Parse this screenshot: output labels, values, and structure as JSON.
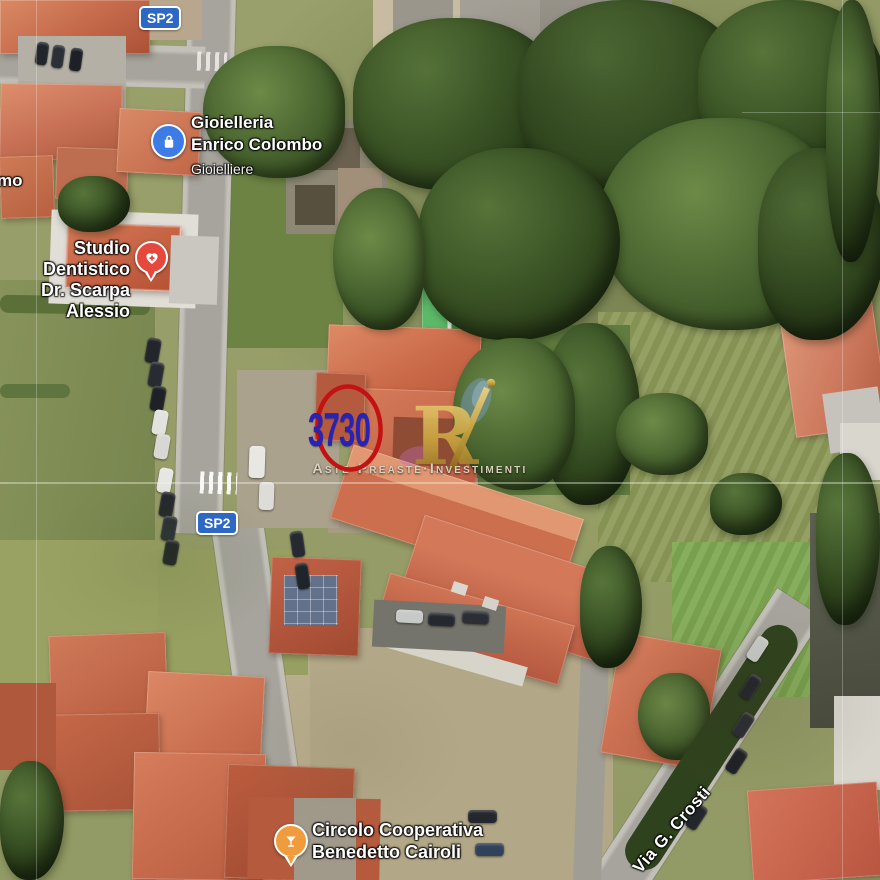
{
  "overlays": {
    "road_badges": [
      {
        "label": "SP2"
      },
      {
        "label": "SP2"
      }
    ],
    "pois": [
      {
        "line1": "Gioielleria",
        "line2": "Enrico Colombo",
        "subtitle": "Gioielliere",
        "icon": "shopping-bag",
        "icon_color": "#3D7CE6"
      },
      {
        "line1": "Studio Dentistico",
        "line2": "Dr. Scarpa Alessio",
        "icon": "heart-cross",
        "icon_color": "#E5483D"
      },
      {
        "line1": "Circolo Cooperativa",
        "line2": "Benedetto Cairoli",
        "icon": "cocktail-glass",
        "icon_color": "#F09C3C"
      }
    ],
    "street_labels": {
      "via_crosti": "Via G. Crosti",
      "left_truncated": "mo"
    },
    "parcel_marker": {
      "number": "3730",
      "number_color": "#2823B5",
      "circle_color": "#C41212"
    },
    "watermark": {
      "logo_letter": "R",
      "tagline": "Aste·Preaste·Investimenti",
      "gold_color": "#C9A23F"
    }
  }
}
